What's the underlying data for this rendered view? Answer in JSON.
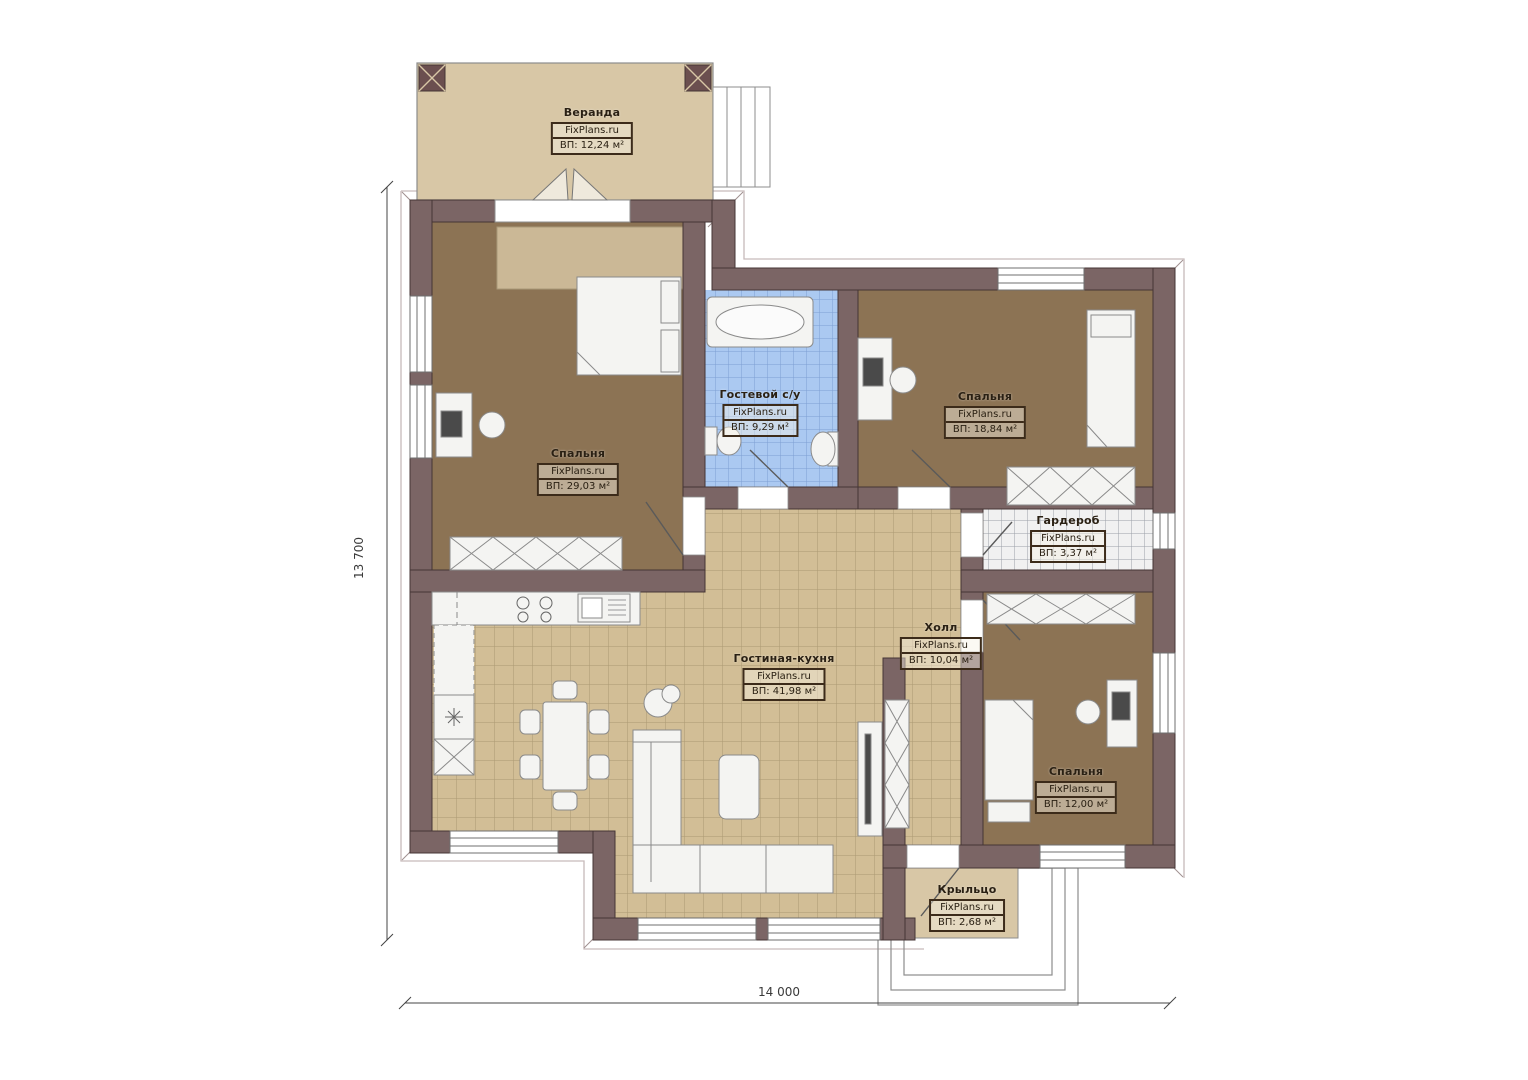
{
  "plan": {
    "brand": "FixPlans.ru",
    "rooms": [
      {
        "id": "veranda",
        "name": "Веранда",
        "area": "ВП: 12,24 м²"
      },
      {
        "id": "bedroom-left",
        "name": "Спальня",
        "area": "ВП: 29,03 м²"
      },
      {
        "id": "guest-bathroom",
        "name": "Гостевой с/у",
        "area": "ВП: 9,29 м²"
      },
      {
        "id": "bedroom-top-right",
        "name": "Спальня",
        "area": "ВП: 18,84 м²"
      },
      {
        "id": "wardrobe",
        "name": "Гардероб",
        "area": "ВП: 3,37 м²"
      },
      {
        "id": "hall",
        "name": "Холл",
        "area": "ВП: 10,04 м²"
      },
      {
        "id": "living-kitchen",
        "name": "Гостиная-кухня",
        "area": "ВП: 41,98 м²"
      },
      {
        "id": "bedroom-bottom-right",
        "name": "Спальня",
        "area": "ВП: 12,00 м²"
      },
      {
        "id": "porch",
        "name": "Крыльцо",
        "area": "ВП: 2,68 м²"
      }
    ],
    "dimensions": {
      "width_label": "14 000",
      "height_label": "13 700"
    },
    "colors": {
      "wall": "#7b6565",
      "bedroom_floor": "#8c7354",
      "tile_tan": "#d2be96",
      "tile_blue": "#abc9f1",
      "veranda": "#d8c7a6"
    }
  }
}
